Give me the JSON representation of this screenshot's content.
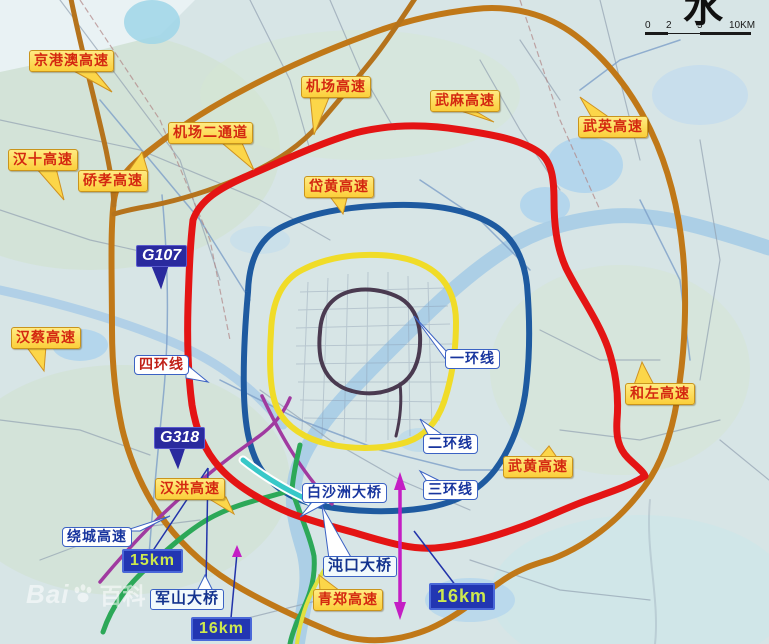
{
  "scale_bar": {
    "ticks": [
      "0",
      "2",
      "5",
      "10KM"
    ]
  },
  "corner_glyph": "水",
  "watermark": {
    "part1": "Bai",
    "part2": "百科"
  },
  "callouts_yellow": [
    {
      "id": "jinggangao",
      "label": "京港澳高速"
    },
    {
      "id": "jichang",
      "label": "机场高速"
    },
    {
      "id": "wuma",
      "label": "武麻高速"
    },
    {
      "id": "wuying",
      "label": "武英高速"
    },
    {
      "id": "jichang2",
      "label": "机场二通道"
    },
    {
      "id": "hanshi",
      "label": "汉十高速"
    },
    {
      "id": "qiaoxiao",
      "label": "硚孝高速"
    },
    {
      "id": "daihuang",
      "label": "岱黄高速"
    },
    {
      "id": "hancai",
      "label": "汉蔡高速"
    },
    {
      "id": "hezuo",
      "label": "和左高速"
    },
    {
      "id": "wuhuang",
      "label": "武黄高速"
    },
    {
      "id": "hanhong",
      "label": "汉洪高速"
    },
    {
      "id": "qingzheng",
      "label": "青郑高速"
    }
  ],
  "callouts_blue": [
    {
      "id": "sihuan",
      "label": "四环线"
    },
    {
      "id": "yihuan",
      "label": "一环线"
    },
    {
      "id": "erhuan",
      "label": "二环线"
    },
    {
      "id": "sanhuan",
      "label": "三环线"
    },
    {
      "id": "baishazhou",
      "label": "白沙洲大桥"
    },
    {
      "id": "raocheng",
      "label": "绕城高速"
    }
  ],
  "shields": [
    {
      "id": "g107",
      "label": "G107"
    },
    {
      "id": "g318",
      "label": "G318"
    }
  ],
  "bridge_labels": [
    {
      "id": "junshan",
      "label": "军山大桥"
    },
    {
      "id": "dunkou",
      "label": "沌口大桥"
    }
  ],
  "distance_badges": [
    {
      "id": "km15",
      "label": "15km"
    },
    {
      "id": "km16_left",
      "label": "16km"
    },
    {
      "id": "km16_right",
      "label": "16km"
    }
  ],
  "route_colors": {
    "ring_expressway_orange": "#c07818",
    "fourth_ring_red": "#e41414",
    "third_ring_blue": "#1e5aa0",
    "second_ring_yellow": "#f0dc28",
    "first_ring_dark": "#4a3a50",
    "green_route": "#2ca858",
    "bridge_cyan": "#38c8c8",
    "g318_magenta": "#a03aa0",
    "measure_arrow_purple": "#c41ec4"
  }
}
